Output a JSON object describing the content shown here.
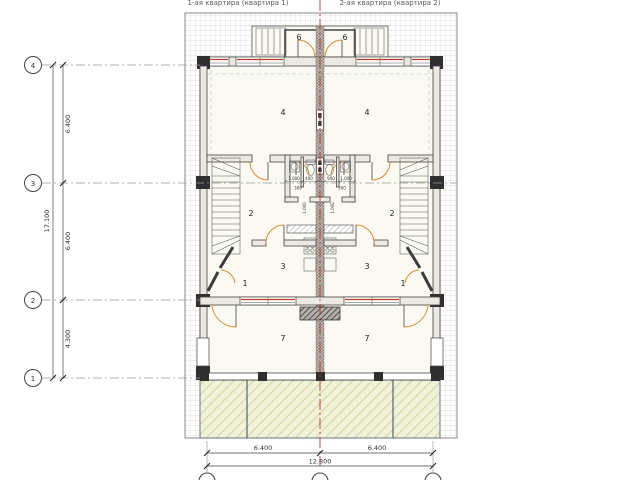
{
  "header": {
    "apartment1_label": "1-ая квартира (квартира 1)",
    "apartment2_label": "2-ая квартира (квартира 2)"
  },
  "axes": {
    "left_bubbles": [
      "4",
      "3",
      "2",
      "1"
    ]
  },
  "dimensions": {
    "left_span_4_3": "6.400",
    "left_span_3_2": "6.400",
    "left_span_2_1": "4.300",
    "left_total": "17.100",
    "bottom_span_left": "6.400",
    "bottom_span_right": "6.400",
    "bottom_total": "12.800",
    "interior": {
      "w1": "1.000",
      "w2": "400",
      "w3": "900",
      "w4": "1.000",
      "s1": "300",
      "s2": "300",
      "v1": "1.000",
      "v2": "1.000"
    }
  },
  "rooms": {
    "living": "4",
    "hall": "2",
    "room3": "3",
    "room1": "1",
    "veranda": "7",
    "porch": "6"
  },
  "colors": {
    "door_arc": "#d88c34",
    "window_accent": "#c0392b",
    "centerline_red": "#b5342c",
    "wall_dark": "#2f2f2f",
    "terrace_fill": "#f1f2da",
    "terrace_hatch_line": "#d3d79f",
    "site_grid_line": "#d9d9d9",
    "center_wall_fill": "#cac3bb"
  }
}
